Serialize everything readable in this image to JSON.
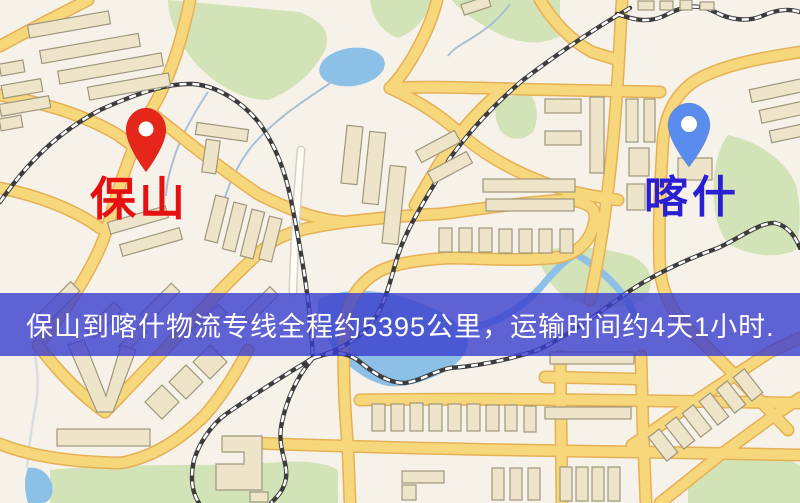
{
  "banner": {
    "text": "保山到喀什物流专线全程约5395公里，运输时间约4天1小时.",
    "bg_color": "rgba(58,61,205,0.8)",
    "text_color": "#ffffff"
  },
  "markers": [
    {
      "id": "baoshan",
      "label": "保山",
      "label_color": "#e51010",
      "pin_color": "#e5261b"
    },
    {
      "id": "kashgar",
      "label": "喀什",
      "label_color": "#2b1fd4",
      "pin_color": "#5a8cee"
    }
  ],
  "map": {
    "background_color": "#f6f2ea",
    "road_color": "#f7d77c",
    "road_casing_color": "#e6b054",
    "building_color": "#ede4c9",
    "building_outline_color": "#9f977d",
    "green_color": "#d3e3b8",
    "water_color": "#8cc0e6",
    "railway_color": "#3c3c3c"
  }
}
